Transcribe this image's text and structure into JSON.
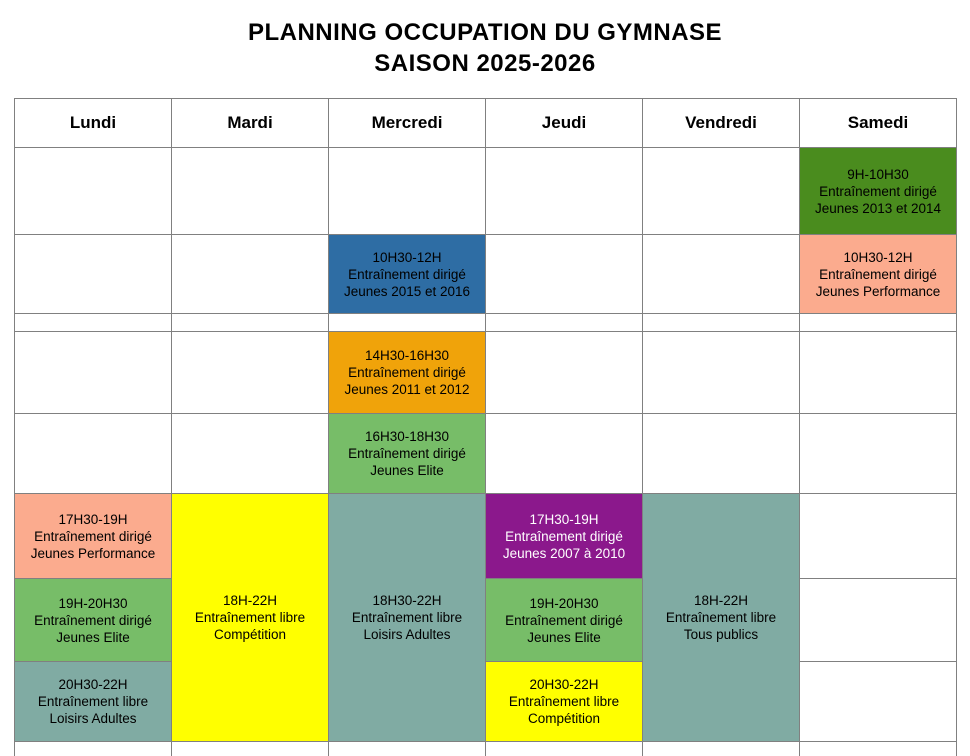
{
  "title": {
    "line1": "PLANNING OCCUPATION DU GYMNASE",
    "line2": "SAISON 2025-2026"
  },
  "days": [
    "Lundi",
    "Mardi",
    "Mercredi",
    "Jeudi",
    "Vendredi",
    "Samedi"
  ],
  "colors": {
    "grid_border": "#808080",
    "dark_green": "#4a8c1e",
    "salmon": "#fbab8e",
    "blue": "#2e6da4",
    "orange": "#f0a30a",
    "light_green": "#77bd68",
    "yellow": "#ffff00",
    "teal": "#80aba3",
    "purple": "#8b188c",
    "default_text": "#000000",
    "purple_cell_text": "#ffffff"
  },
  "events": {
    "sam_matin1": {
      "time": "9H-10H30",
      "type": "Entraînement dirigé",
      "group": "Jeunes 2013 et 2014"
    },
    "mer_matin": {
      "time": "10H30-12H",
      "type": "Entraînement dirigé",
      "group": "Jeunes 2015 et 2016"
    },
    "sam_matin2": {
      "time": "10H30-12H",
      "type": "Entraînement dirigé",
      "group": "Jeunes Performance"
    },
    "mer_aprem1": {
      "time": "14H30-16H30",
      "type": "Entraînement dirigé",
      "group": "Jeunes 2011 et 2012"
    },
    "mer_aprem2": {
      "time": "16H30-18H30",
      "type": "Entraînement dirigé",
      "group": "Jeunes Elite"
    },
    "lun_soir1": {
      "time": "17H30-19H",
      "type": "Entraînement dirigé",
      "group": "Jeunes Performance"
    },
    "lun_soir2": {
      "time": "19H-20H30",
      "type": "Entraînement dirigé",
      "group": "Jeunes Elite"
    },
    "lun_soir3": {
      "time": "20H30-22H",
      "type": "Entraînement libre",
      "group": "Loisirs Adultes"
    },
    "mar_soir": {
      "time": "18H-22H",
      "type": "Entraînement libre",
      "group": "Compétition"
    },
    "mer_soir": {
      "time": "18H30-22H",
      "type": "Entraînement libre",
      "group": "Loisirs Adultes"
    },
    "jeu_soir1": {
      "time": "17H30-19H",
      "type": "Entraînement dirigé",
      "group": "Jeunes 2007 à 2010"
    },
    "jeu_soir2": {
      "time": "19H-20H30",
      "type": "Entraînement dirigé",
      "group": "Jeunes Elite"
    },
    "jeu_soir3": {
      "time": "20H30-22H",
      "type": "Entraînement libre",
      "group": "Compétition"
    },
    "ven_soir": {
      "time": "18H-22H",
      "type": "Entraînement libre",
      "group": "Tous publics"
    }
  }
}
